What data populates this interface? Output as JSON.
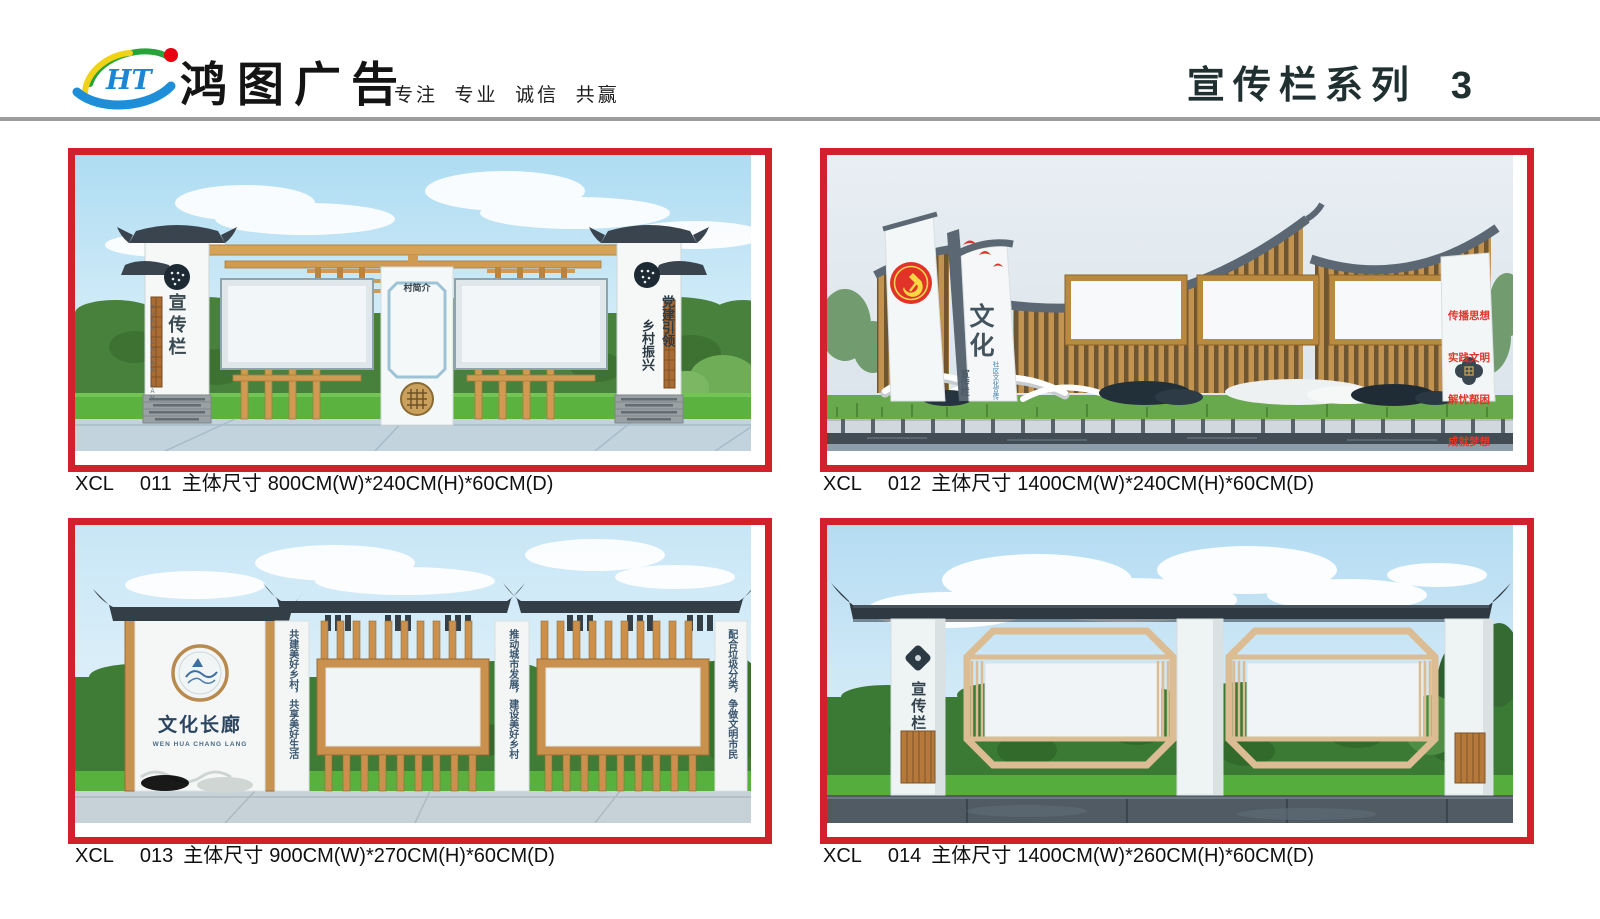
{
  "header": {
    "logo_letters": "HT",
    "company_name": "鸿图广告",
    "slogan": "专注  专业  诚信  共赢",
    "series_title": "宣传栏系列",
    "page_number": "3"
  },
  "colors": {
    "frame_red": "#d1212a",
    "divider_gray": "#9c9c9c",
    "party_red": "#e13228",
    "slogan_red": "#e0372b",
    "wood": "#c9914d",
    "roof_dark": "#333e47",
    "logo_blue": "#1b86d4",
    "logo_green": "#27a338",
    "logo_yellow": "#f0d316",
    "logo_red_dot": "#e60012"
  },
  "icons": {
    "logo": "ht-swoosh-logo",
    "product1_pillar_seal": "round-seal-icon",
    "product1_medallion": "lattice-medallion-icon",
    "product2_emblem": "party-emblem-icon",
    "product2_birds": "red-birds-icon",
    "product3_emblem": "landscape-medallion-icon",
    "product4_emblem": "diamond-seal-icon"
  },
  "products": [
    {
      "code": "XCL",
      "model": "011",
      "size_label": "主体尺寸",
      "dimensions": "800CM(W)*240CM(H)*60CM(D)",
      "texts": {
        "pillar_left": "宣传栏",
        "pillar_left_en": "XUAN CHUAN LAN",
        "pillar_right_col1": "党建引领",
        "pillar_right_col2": "乡村振兴",
        "center_panel": "村简介"
      }
    },
    {
      "code": "XCL",
      "model": "012",
      "size_label": "主体尺寸",
      "dimensions": "1400CM(W)*240CM(H)*60CM(D)",
      "texts": {
        "main_title": "文化",
        "sub_title": "宣传栏",
        "side_note": "社区文化宣传",
        "slogan_1": "传播思想",
        "slogan_2": "实践文明",
        "slogan_3": "解忧帮困",
        "slogan_4": "成就梦想"
      }
    },
    {
      "code": "XCL",
      "model": "013",
      "size_label": "主体尺寸",
      "dimensions": "900CM(W)*270CM(H)*60CM(D)",
      "texts": {
        "wall_title": "文化长廊",
        "wall_title_en": "WEN HUA CHANG LANG",
        "pillar_1": "共建美好乡村，共享美好生活",
        "pillar_2": "推动城市发展，建设美好乡村",
        "pillar_3": "配合垃圾分类，争做文明市民"
      }
    },
    {
      "code": "XCL",
      "model": "014",
      "size_label": "主体尺寸",
      "dimensions": "1400CM(W)*260CM(H)*60CM(D)",
      "texts": {
        "pillar_left": "宣传栏"
      }
    }
  ]
}
